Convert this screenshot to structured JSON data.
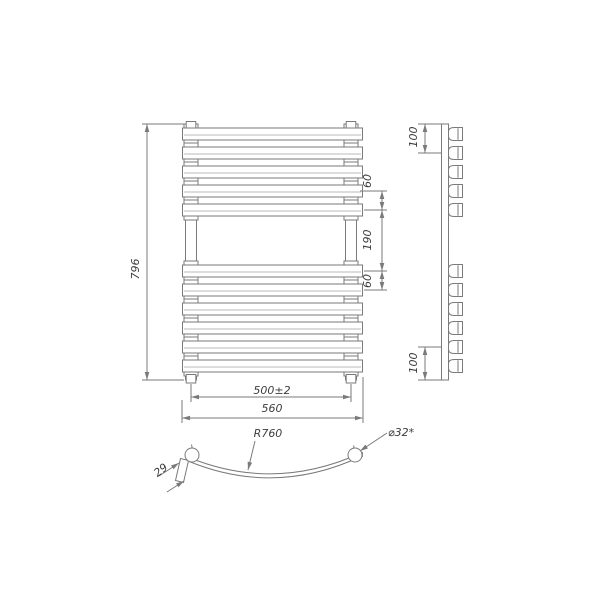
{
  "page": {
    "background": "#ffffff"
  },
  "colors": {
    "line": "#7a7a7a",
    "line_light": "#a3a3a3",
    "text": "#3d3d3d"
  },
  "drawing": {
    "subject": "heated-towel-rail-three-view-technical-drawing",
    "views": {
      "front": "front view",
      "side": "side view",
      "bottom": "bottom bar top view"
    },
    "front_view": {
      "bar_count": 11,
      "top_group_bars": 5,
      "bottom_group_bars": 6
    },
    "labels": {
      "overall_height": "796",
      "bar_pitch_top": "60",
      "middle_gap": "190",
      "bar_pitch_bottom": "60",
      "collector_spacing": "500±2",
      "overall_width": "560",
      "mount_offset_top": "100",
      "mount_offset_bottom": "100",
      "bar_bend_radius": "R760",
      "collector_diameter": "⌀32*",
      "bar_profile_depth": "29"
    }
  },
  "geometry": {
    "front": {
      "bar_centers": [
        134,
        153,
        172,
        191,
        210,
        271,
        290,
        309,
        328,
        347,
        366
      ],
      "bar_x": 182.5,
      "bar_w": 180,
      "bar_h": 12,
      "left_stub_x": 184,
      "right_stub_x": 344,
      "stub_w": 14,
      "stub_half_h": 10
    },
    "side": {
      "cup_x": 448.5,
      "cup_right": 462.5,
      "cup_half_h": 6.5,
      "inner_line_x": 458
    }
  }
}
